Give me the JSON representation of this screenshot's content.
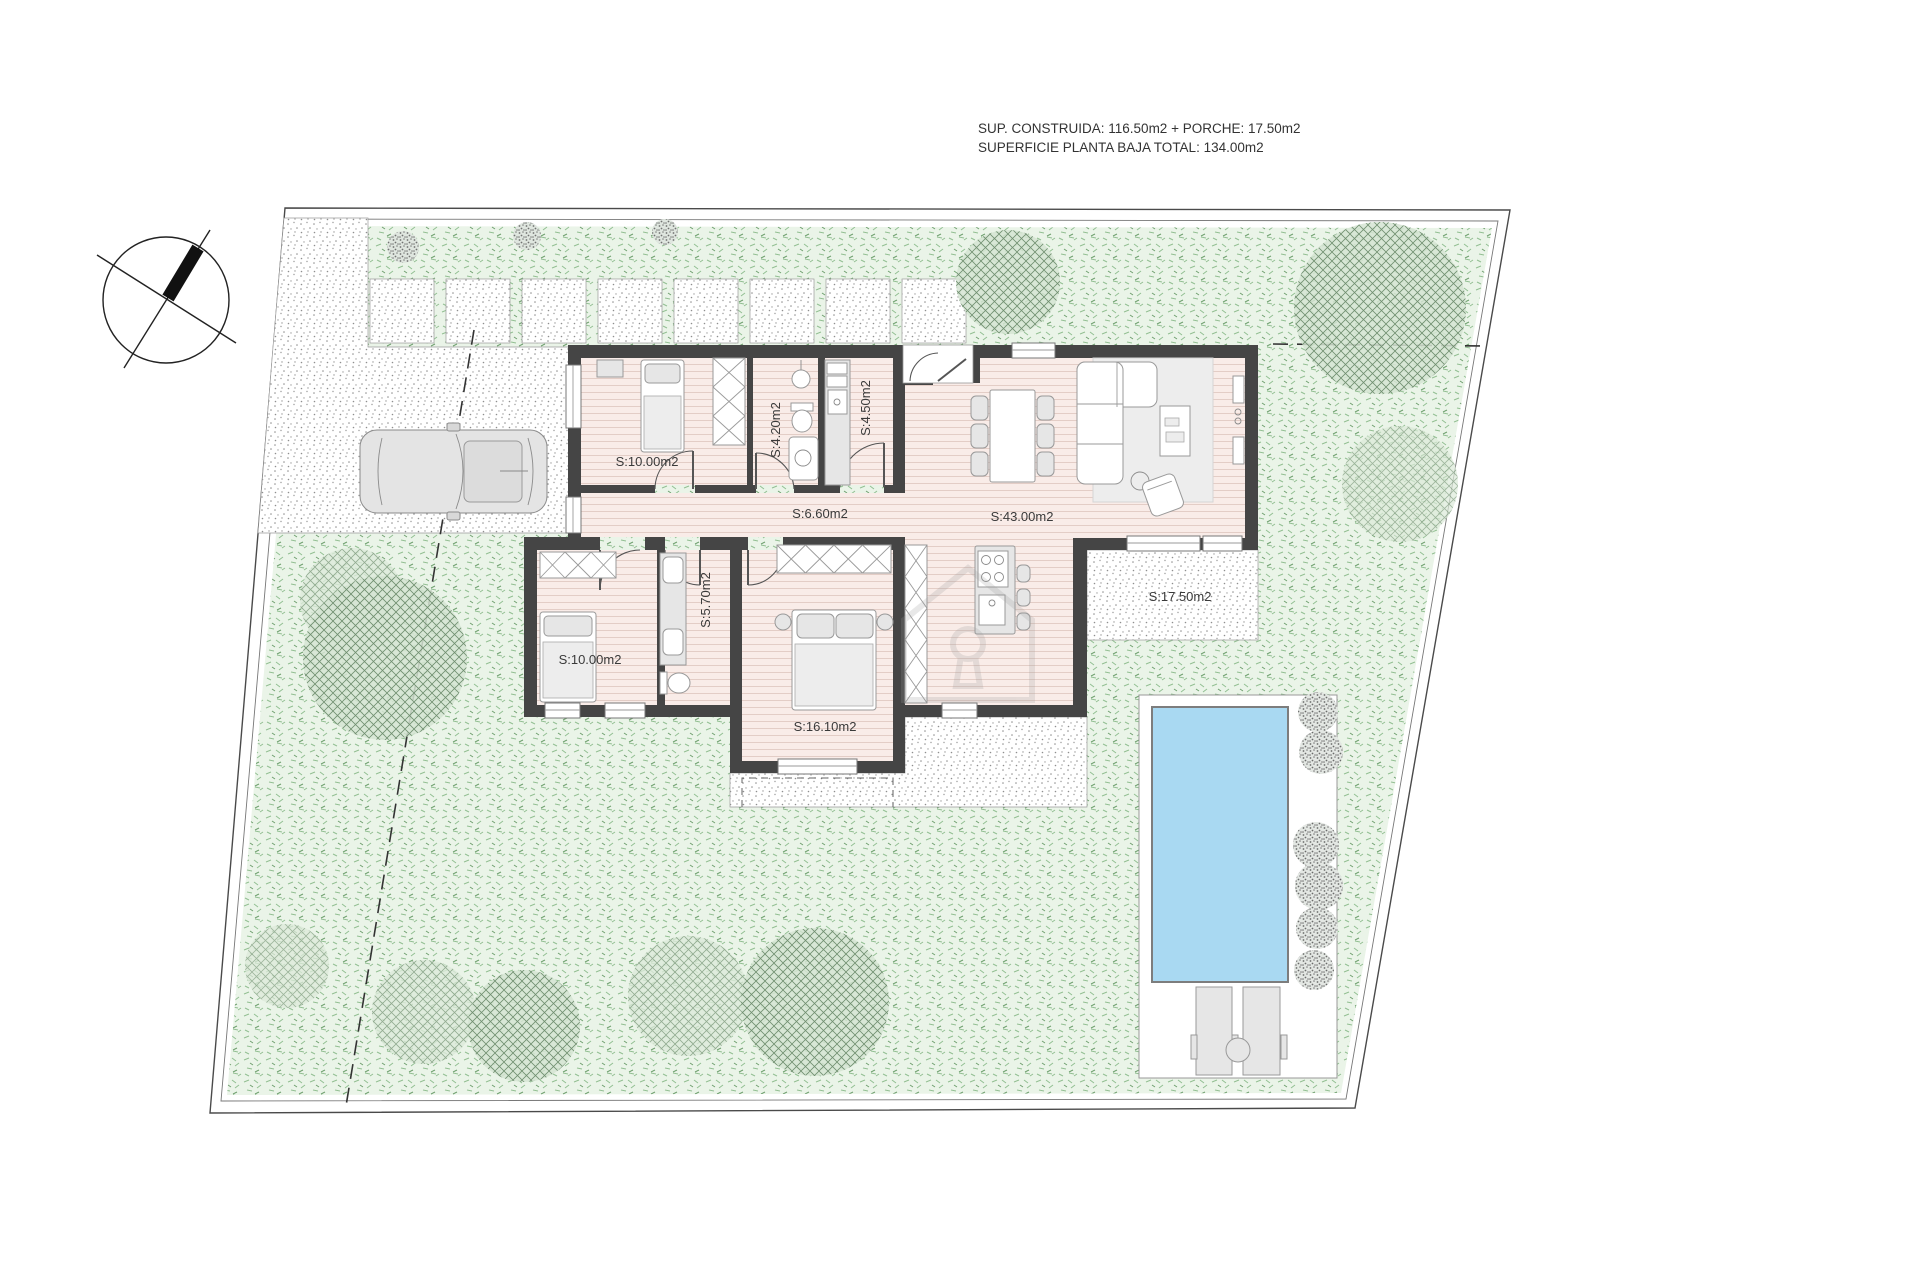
{
  "title_block": {
    "line1": "SUP. CONSTRUIDA: 116.50m2 + PORCHE: 17.50m2",
    "line2": "SUPERFICIE PLANTA BAJA TOTAL: 134.00m2"
  },
  "plan": {
    "rooms": [
      {
        "id": "bedroom-1",
        "label": "S:10.00m2"
      },
      {
        "id": "bathroom-1",
        "label": "S:4.20m2"
      },
      {
        "id": "laundry-room",
        "label": "S:4.50m2"
      },
      {
        "id": "hallway",
        "label": "S:6.60m2"
      },
      {
        "id": "living-dining-kitchen",
        "label": "S:43.00m2"
      },
      {
        "id": "porch",
        "label": "S:17.50m2"
      },
      {
        "id": "bathroom-2",
        "label": "S:5.70m2"
      },
      {
        "id": "bedroom-2",
        "label": "S:10.00m2"
      },
      {
        "id": "bedroom-3",
        "label": "S:16.10m2"
      }
    ],
    "colors": {
      "wall": "#454545",
      "floor": "#f9ece8",
      "grass": "#eaf4e8",
      "grass_stroke": "#93bf93",
      "stipple_dot": "#8f8f8f",
      "water": "#a9d9f2",
      "tree": "#5e805e",
      "label_text": "#3a3a3a",
      "furniture": "#e6e6e6"
    }
  }
}
